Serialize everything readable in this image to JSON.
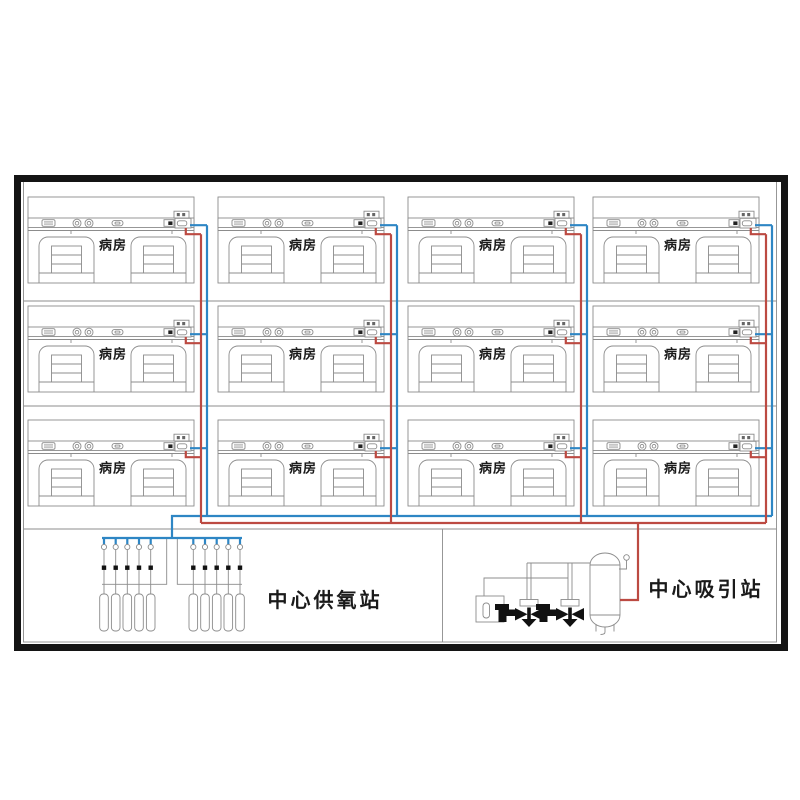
{
  "ward_label": "病房",
  "stations": {
    "oxygen": {
      "label": "中心供氧站"
    },
    "suction": {
      "label": "中心吸引站"
    }
  },
  "layout": {
    "ward_columns": 4,
    "ward_rows": 3,
    "ward_count": 12
  },
  "equipment": {
    "oxygen_cylinders": 10,
    "oxygen_cylinder_groups": 2,
    "manifold_valves": 10,
    "vacuum_pumps": 2,
    "vacuum_tanks": 1
  },
  "colors": {
    "oxygen_pipe": "#2E86C4",
    "suction_pipe": "#BC4A42",
    "outline": "#8C8C8C",
    "frame": "#141414",
    "text": "#1A1A1A"
  },
  "icons": {
    "ward": [
      "nurse-panel-icon",
      "gas-outlet-icon",
      "gas-outlet-icon",
      "switch-icon",
      "power-socket-icon",
      "alarm-box-icon",
      "terminal-box-icon",
      "bed-icon",
      "bed-icon"
    ],
    "oxygen_station": [
      "manifold-valve-icon",
      "gas-cylinder-icon"
    ],
    "suction_station": [
      "control-cabinet-icon",
      "vacuum-pump-icon",
      "vacuum-tank-icon",
      "pressure-gauge-icon"
    ]
  }
}
